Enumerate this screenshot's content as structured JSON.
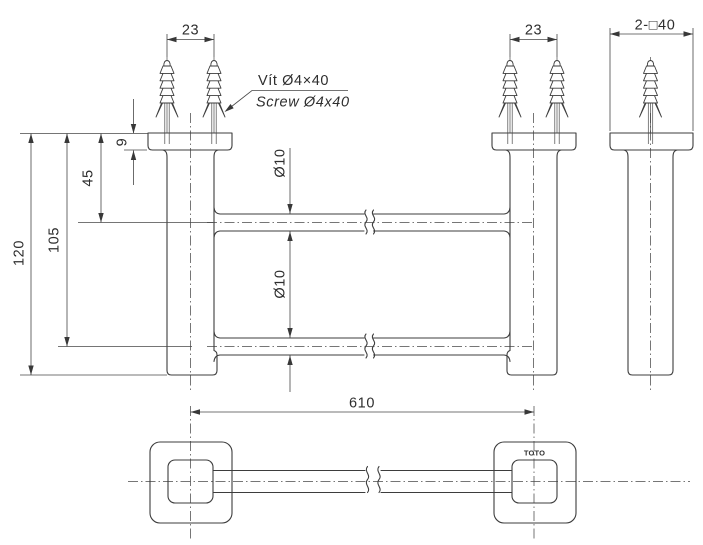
{
  "colors": {
    "background": "#ffffff",
    "line": "#3d3d3d",
    "text": "#2e2e2e"
  },
  "brand_mark": "TOTO",
  "annotations": {
    "screw_label_vi": "Vít Ø4×40",
    "screw_label_en": "Screw Ø4x40"
  },
  "dimensions": {
    "screw_spacing_left": "23",
    "screw_spacing_right": "23",
    "post_section": "2-□40",
    "flange_thickness": "9",
    "top_bar_offset": "45",
    "bottom_bar_offset": "105",
    "overall_height": "120",
    "top_bar_diameter": "Ø10",
    "bottom_bar_diameter": "Ø10",
    "bar_length": "610"
  }
}
